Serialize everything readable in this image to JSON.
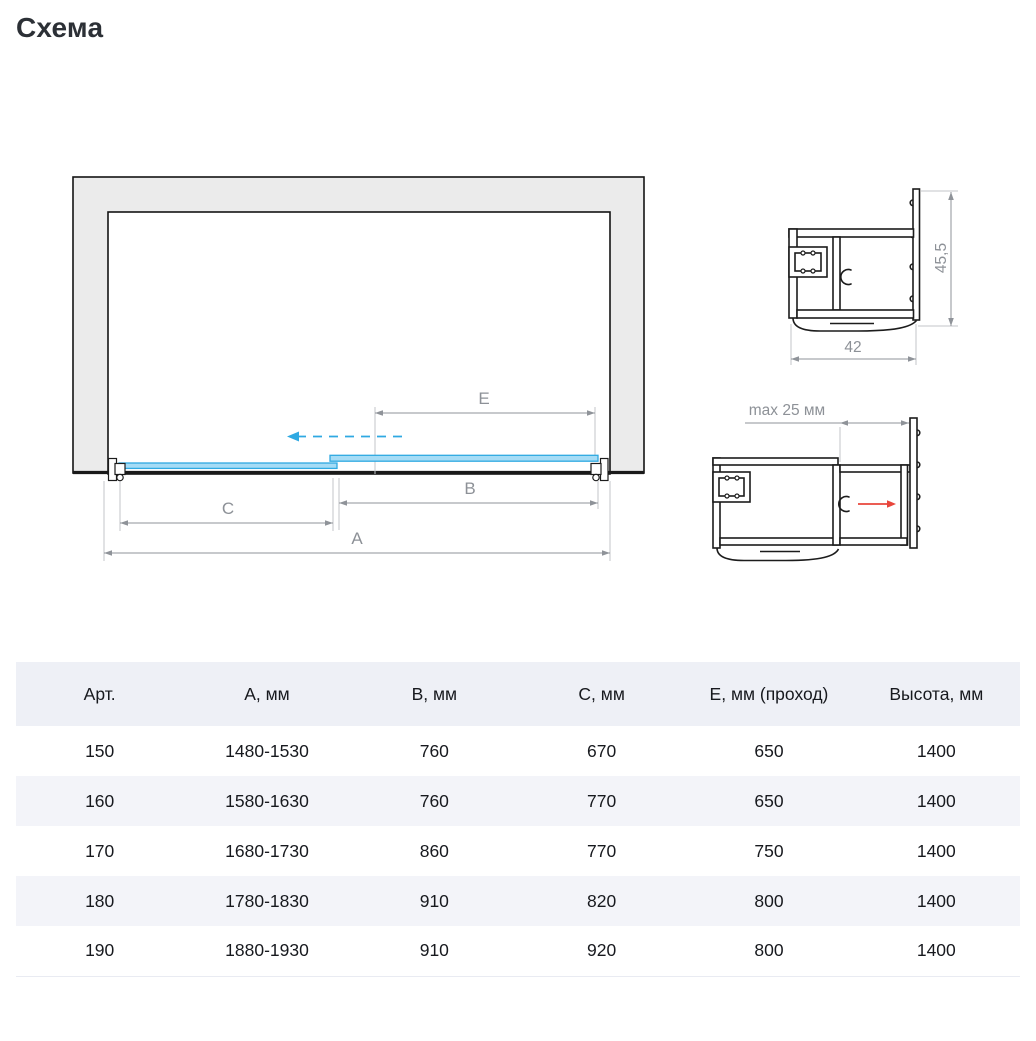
{
  "page": {
    "title": "Схема"
  },
  "plan": {
    "dim_a_label": "А",
    "dim_b_label": "В",
    "dim_c_label": "С",
    "dim_e_label": "Е"
  },
  "profile_top": {
    "height_label": "45,5",
    "width_label": "42"
  },
  "profile_bottom": {
    "gap_label": "max 25 мм"
  },
  "colors": {
    "glass_blue_stroke": "#2fa9e2",
    "glass_blue_fill": "#a5dcf6",
    "arrow_red": "#e8463c",
    "wall_fill": "#ebebeb",
    "dimension_gray": "#8f9399",
    "table_header_bg": "#eef0f6",
    "table_row_alt_bg": "#f3f4f9"
  },
  "table": {
    "columns": [
      "Арт.",
      "А, мм",
      "В, мм",
      "С, мм",
      "Е, мм (проход)",
      "Высота, мм"
    ],
    "rows": [
      [
        "150",
        "1480-1530",
        "760",
        "670",
        "650",
        "1400"
      ],
      [
        "160",
        "1580-1630",
        "760",
        "770",
        "650",
        "1400"
      ],
      [
        "170",
        "1680-1730",
        "860",
        "770",
        "750",
        "1400"
      ],
      [
        "180",
        "1780-1830",
        "910",
        "820",
        "800",
        "1400"
      ],
      [
        "190",
        "1880-1930",
        "910",
        "920",
        "800",
        "1400"
      ]
    ]
  }
}
